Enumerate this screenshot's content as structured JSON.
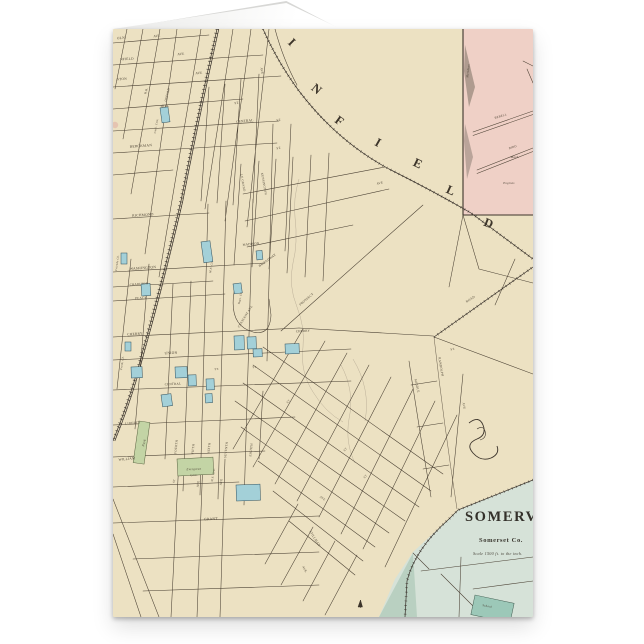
{
  "scene": {
    "background": "#ffffff"
  },
  "card": {
    "type_note": "folded greeting card, map printed edge-to-edge on front",
    "palette": {
      "paper": "#ece1c2",
      "ink": "#4a4033",
      "ink_dark": "#37302a",
      "inset_pink": "#efd0c6",
      "building_blue": "#a3d0d8",
      "building_blue_stroke": "#2f4f5c",
      "green": "#c3d4a5",
      "green_stroke": "#57603f",
      "somerset_fill": "#d6e2d8",
      "somerset_dark": "#b9d0c1",
      "teal": "#9cc8b8",
      "teal_stroke": "#3f5a4e"
    }
  },
  "map": {
    "title_letters": [
      {
        "ch": "I",
        "x": 176,
        "y": 16,
        "r": 45
      },
      {
        "ch": "N",
        "x": 201,
        "y": 63,
        "r": 40
      },
      {
        "ch": "F",
        "x": 224,
        "y": 95,
        "r": 36
      },
      {
        "ch": "I",
        "x": 263,
        "y": 117,
        "r": 30
      },
      {
        "ch": "E",
        "x": 303,
        "y": 138,
        "r": 26
      },
      {
        "ch": "L",
        "x": 336,
        "y": 165,
        "r": 24
      },
      {
        "ch": "D",
        "x": 374,
        "y": 198,
        "r": 22
      }
    ],
    "somerville": {
      "title": "SOMERVILLE",
      "county": "Somerset Co.",
      "scale": "Scale 1500 ft. to the inch.",
      "school": "School"
    },
    "street_labels": [
      {
        "t": "OLN",
        "x": 8,
        "y": 10,
        "r": -4,
        "s": 3.5
      },
      {
        "t": "AVE",
        "x": 44,
        "y": 8,
        "r": -4,
        "s": 3.3
      },
      {
        "t": "NFIELD",
        "x": 14,
        "y": 31,
        "r": -4,
        "s": 3.4
      },
      {
        "t": "AVE",
        "x": 68,
        "y": 26,
        "r": -4,
        "s": 3.3
      },
      {
        "t": "STON",
        "x": 9,
        "y": 51,
        "r": -4,
        "s": 3.4
      },
      {
        "t": "AVE",
        "x": 86,
        "y": 45,
        "r": -4,
        "s": 3.3
      },
      {
        "t": "AVE",
        "x": 148,
        "y": 42,
        "r": 80,
        "s": 3.2
      },
      {
        "t": "HILL",
        "x": 52,
        "y": 78,
        "r": -4,
        "s": 3.4
      },
      {
        "t": "ST.",
        "x": 124,
        "y": 75,
        "r": -4,
        "s": 3.2
      },
      {
        "t": "CENTRAL",
        "x": 132,
        "y": 93,
        "r": -6,
        "s": 3.4
      },
      {
        "t": "BERCKMAN",
        "x": 28,
        "y": 118,
        "r": -4,
        "s": 3.6
      },
      {
        "t": "R.R.",
        "x": 34,
        "y": 62,
        "r": -75,
        "s": 3.0
      },
      {
        "t": "OXFORD",
        "x": 55,
        "y": 66,
        "r": -75,
        "s": 3.0
      },
      {
        "t": "ST.",
        "x": 166,
        "y": 92,
        "r": -6,
        "s": 3.1
      },
      {
        "t": "ST.",
        "x": 166,
        "y": 120,
        "r": -6,
        "s": 3.1
      },
      {
        "t": "RICHMOND",
        "x": 30,
        "y": 187,
        "r": -4,
        "s": 3.6
      },
      {
        "t": "MADISON",
        "x": 138,
        "y": 216,
        "r": -6,
        "s": 3.2
      },
      {
        "t": "WASHINGTON",
        "x": 30,
        "y": 240,
        "r": -4,
        "s": 3.6
      },
      {
        "t": "CHARLTON",
        "x": 26,
        "y": 256,
        "r": -4,
        "s": 3.1
      },
      {
        "t": "PEACE",
        "x": 28,
        "y": 270,
        "r": -4,
        "s": 3.3
      },
      {
        "t": "CHERRY",
        "x": 22,
        "y": 306,
        "r": -4,
        "s": 3.5
      },
      {
        "t": "CHERRY",
        "x": 190,
        "y": 303,
        "r": -3,
        "s": 3.2
      },
      {
        "t": "UNION",
        "x": 58,
        "y": 325,
        "r": -3,
        "s": 3.6
      },
      {
        "t": "CENTRAL",
        "x": 60,
        "y": 356,
        "r": -3,
        "s": 3.2
      },
      {
        "t": "ST.",
        "x": 104,
        "y": 341,
        "r": -3,
        "s": 3.0
      },
      {
        "t": "ST.",
        "x": 142,
        "y": 339,
        "r": -3,
        "s": 3.0
      },
      {
        "t": "FOURTH",
        "x": 64,
        "y": 418,
        "r": -84,
        "s": 3.2
      },
      {
        "t": "FIFTH",
        "x": 81,
        "y": 420,
        "r": -84,
        "s": 3.2
      },
      {
        "t": "SIXTH",
        "x": 97,
        "y": 419,
        "r": -84,
        "s": 3.2
      },
      {
        "t": "SEVENTH",
        "x": 114,
        "y": 421,
        "r": -84,
        "s": 3.2
      },
      {
        "t": "EIGHTH",
        "x": 139,
        "y": 421,
        "r": -84,
        "s": 3.2
      },
      {
        "t": "LIBERTY",
        "x": 20,
        "y": 395,
        "r": -5,
        "s": 3.3
      },
      {
        "t": "WILLIAM",
        "x": 14,
        "y": 431,
        "r": -5,
        "s": 3.4
      },
      {
        "t": "GRANT",
        "x": 98,
        "y": 491,
        "r": -3,
        "s": 3.6
      },
      {
        "t": "ST",
        "x": 62,
        "y": 452,
        "r": -84,
        "s": 3.0
      },
      {
        "t": "AVE",
        "x": 86,
        "y": 455,
        "r": -84,
        "s": 3.1
      },
      {
        "t": "AVE",
        "x": 109,
        "y": 453,
        "r": -84,
        "s": 3.1
      },
      {
        "t": "BROADWAY",
        "x": 155,
        "y": 232,
        "r": -36,
        "s": 3.3
      },
      {
        "t": "CRESCENT AVE",
        "x": 133,
        "y": 288,
        "r": -58,
        "s": 3.1
      },
      {
        "t": "PROSPECT",
        "x": 194,
        "y": 271,
        "r": -40,
        "s": 3.2
      },
      {
        "t": "KENSINGTON",
        "x": 150,
        "y": 155,
        "r": 80,
        "s": 3.1
      },
      {
        "t": "LE GRAND",
        "x": 129,
        "y": 154,
        "r": 80,
        "s": 3.1
      },
      {
        "t": "AVE",
        "x": 267,
        "y": 155,
        "r": -12,
        "s": 3.1
      },
      {
        "t": "ROAD",
        "x": 358,
        "y": 271,
        "r": -34,
        "s": 3.3
      },
      {
        "t": "ST.",
        "x": 340,
        "y": 321,
        "r": -8,
        "s": 3.1
      },
      {
        "t": "RANDOLPH",
        "x": 327,
        "y": 338,
        "r": 80,
        "s": 3.2
      },
      {
        "t": "MIDDLE",
        "x": 303,
        "y": 357,
        "r": 76,
        "s": 3.2
      },
      {
        "t": "AVE",
        "x": 350,
        "y": 377,
        "r": 82,
        "s": 3.1
      },
      {
        "t": "STILLMAN",
        "x": 201,
        "y": 510,
        "r": 58,
        "s": 3.2
      },
      {
        "t": "AVE.",
        "x": 191,
        "y": 541,
        "r": 58,
        "s": 3.1
      },
      {
        "t": "ST",
        "x": 233,
        "y": 421,
        "r": -50,
        "s": 2.9
      },
      {
        "t": "ST",
        "x": 253,
        "y": 448,
        "r": -50,
        "s": 2.9
      },
      {
        "t": "AVE",
        "x": 209,
        "y": 470,
        "r": 36,
        "s": 2.9
      },
      {
        "t": "ST",
        "x": 176,
        "y": 373,
        "r": -50,
        "s": 2.9
      },
      {
        "t": "Meridian",
        "x": 356,
        "y": 42,
        "r": -84,
        "s": 3.1,
        "it": true
      },
      {
        "t": "BEBELL",
        "x": 388,
        "y": 88,
        "r": -17,
        "s": 3.0
      },
      {
        "t": "BIRD",
        "x": 400,
        "y": 119,
        "r": -17,
        "s": 3.0
      },
      {
        "t": "Mach.",
        "x": 402,
        "y": 129,
        "r": 0,
        "s": 3.0,
        "it": true
      },
      {
        "t": "Engines",
        "x": 396,
        "y": 155,
        "r": 0,
        "s": 3.0,
        "it": true
      },
      {
        "t": "Friends Ch.",
        "x": 5,
        "y": 234,
        "r": -82,
        "s": 2.8,
        "it": true
      },
      {
        "t": "Cath. Cem.",
        "x": 44,
        "y": 97,
        "r": -80,
        "s": 2.8,
        "it": true
      },
      {
        "t": "M.E. Ch.",
        "x": 99,
        "y": 238,
        "r": -80,
        "s": 2.8,
        "it": true
      },
      {
        "t": "Bapt. Ch.",
        "x": 128,
        "y": 269,
        "r": -78,
        "s": 2.8,
        "it": true
      },
      {
        "t": "Presb. Ch.",
        "x": 10,
        "y": 334,
        "r": -82,
        "s": 2.8,
        "it": true
      },
      {
        "t": "Park",
        "x": 32,
        "y": 414,
        "r": -75,
        "s": 3.3,
        "it": true
      },
      {
        "t": "Evergreen",
        "x": 81,
        "y": 441,
        "r": -2,
        "s": 3.1,
        "it": true
      },
      {
        "t": "Cem.",
        "x": 81,
        "y": 447,
        "r": -2,
        "s": 3.1,
        "it": true
      },
      {
        "t": "M.E. Cem.",
        "x": 101,
        "y": 446,
        "r": -80,
        "s": 2.7,
        "it": true
      }
    ],
    "buildings": [
      {
        "x": 47,
        "y": 79,
        "w": 8,
        "h": 15,
        "r": -8,
        "c": "blue"
      },
      {
        "x": 8,
        "y": 224,
        "w": 6,
        "h": 11,
        "r": 0,
        "c": "blue"
      },
      {
        "x": 28,
        "y": 255,
        "w": 9,
        "h": 12,
        "r": -4,
        "c": "blue"
      },
      {
        "x": 88,
        "y": 213,
        "w": 9,
        "h": 21,
        "r": -8,
        "c": "blue"
      },
      {
        "x": 120,
        "y": 255,
        "w": 8,
        "h": 10,
        "r": -8,
        "c": "blue"
      },
      {
        "x": 121,
        "y": 307,
        "w": 10,
        "h": 14,
        "r": -2,
        "c": "blue"
      },
      {
        "x": 134,
        "y": 308,
        "w": 9,
        "h": 12,
        "r": -2,
        "c": "blue"
      },
      {
        "x": 172,
        "y": 315,
        "w": 14,
        "h": 10,
        "r": -2,
        "c": "blue"
      },
      {
        "x": 75,
        "y": 346,
        "w": 8,
        "h": 11,
        "r": -2,
        "c": "blue"
      },
      {
        "x": 93,
        "y": 350,
        "w": 8,
        "h": 11,
        "r": -2,
        "c": "blue"
      },
      {
        "x": 18,
        "y": 338,
        "w": 11,
        "h": 11,
        "r": -2,
        "c": "blue"
      },
      {
        "x": 62,
        "y": 338,
        "w": 12,
        "h": 11,
        "r": -2,
        "c": "blue"
      },
      {
        "x": 140,
        "y": 320,
        "w": 9,
        "h": 8,
        "r": -2,
        "c": "blue"
      },
      {
        "x": 123,
        "y": 456,
        "w": 24,
        "h": 16,
        "r": -2,
        "c": "blue"
      },
      {
        "x": 12,
        "y": 313,
        "w": 6,
        "h": 9,
        "r": 0,
        "c": "blue"
      },
      {
        "x": 143,
        "y": 222,
        "w": 6,
        "h": 9,
        "r": -6,
        "c": "blue"
      },
      {
        "x": 48,
        "y": 366,
        "w": 10,
        "h": 12,
        "r": -8,
        "c": "blue"
      },
      {
        "x": 92,
        "y": 365,
        "w": 7,
        "h": 9,
        "r": -4,
        "c": "blue"
      },
      {
        "x": 26,
        "y": 392,
        "w": 11,
        "h": 42,
        "r": 8,
        "c": "green"
      },
      {
        "x": 64,
        "y": 430,
        "w": 36,
        "h": 17,
        "r": -3,
        "c": "green"
      },
      {
        "x": 362,
        "y": 566,
        "w": 40,
        "h": 20,
        "r": 12,
        "c": "teal"
      }
    ]
  }
}
